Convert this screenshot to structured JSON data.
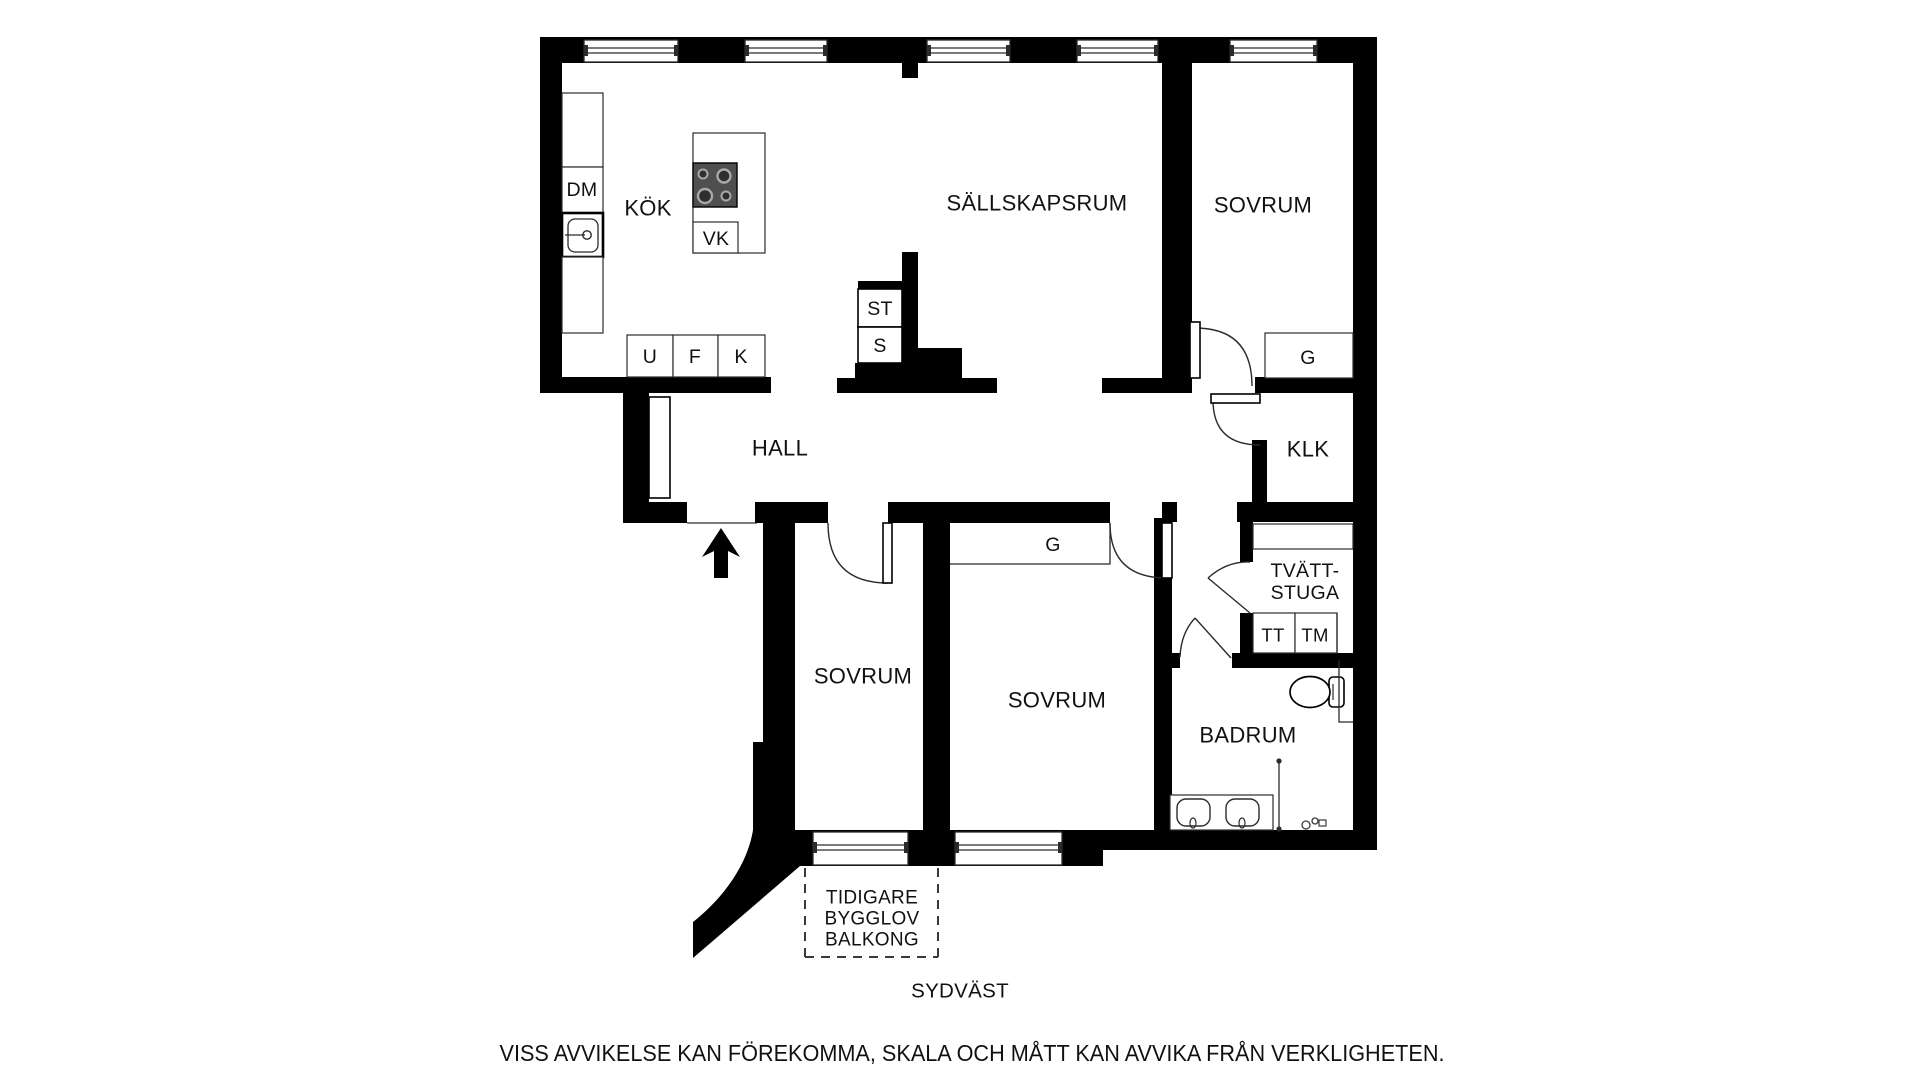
{
  "colors": {
    "wall": "#000000",
    "background": "#ffffff",
    "stove": "#4f4f4f",
    "detail_line": "#2b2b2b"
  },
  "rooms": {
    "kitchen": "KÖK",
    "living": "SÄLLSKAPSRUM",
    "bedroom_ne": "SOVRUM",
    "hall": "HALL",
    "closet_klk": "KLK",
    "laundry_line1": "TVÄTT-",
    "laundry_line2": "STUGA",
    "bedroom_sw": "SOVRUM",
    "bedroom_s": "SOVRUM",
    "bathroom": "BADRUM"
  },
  "fixtures": {
    "dishwasher": "DM",
    "hob": "VK",
    "closet_st": "ST",
    "closet_s": "S",
    "cabinet_u": "U",
    "cabinet_f": "F",
    "cabinet_k": "K",
    "wardrobe_ne": "G",
    "wardrobe_s": "G",
    "dryer": "TT",
    "washer": "TM"
  },
  "balcony": {
    "line1": "TIDIGARE",
    "line2": "BYGGLOV",
    "line3": "BALKONG"
  },
  "compass": "SYDVÄST",
  "disclaimer": "VISS AVVIKELSE KAN FÖREKOMMA, SKALA OCH MÅTT KAN AVVIKA FRÅN VERKLIGHETEN."
}
